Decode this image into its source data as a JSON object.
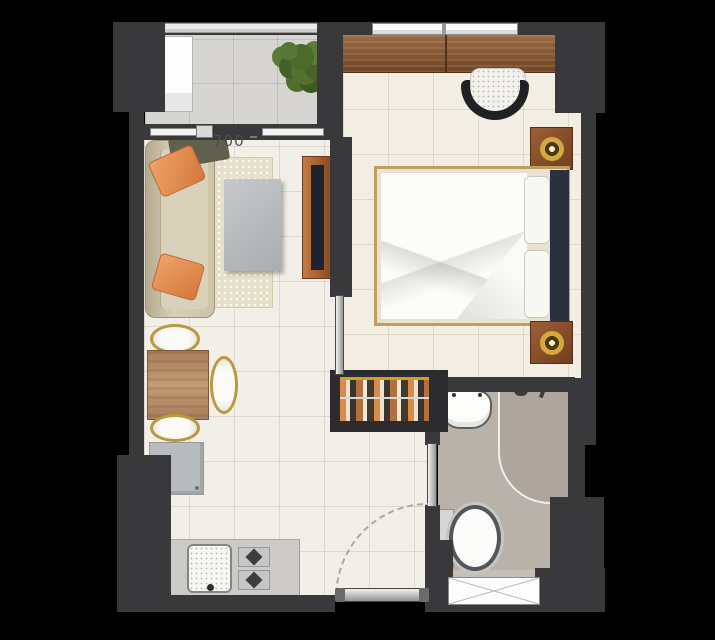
{
  "dimension_label": "700",
  "colors": {
    "background": "#000000",
    "wall": "#39393b",
    "living_floor": "#f1efe8",
    "balcony_floor": "#d7d5d1",
    "bedroom_floor": "#f3eee3",
    "bathroom_floor": "#b9b2aa",
    "wood": "#8a5c3c",
    "sofa_beige": "#cfc5ab",
    "pillow_orange": "#e59057",
    "gold_accent": "#c8a22c",
    "counter_gray": "#cccbc9",
    "headboard_navy": "#2b303f"
  },
  "rooms": {
    "balcony": [
      "potted-plant-icon",
      "ac-unit-icon",
      "balcony-railing",
      "sliding-door-icon"
    ],
    "living_room": [
      "sofa-icon",
      "throw-pillow-icon",
      "blanket-icon",
      "rug-icon",
      "coffee-table-icon",
      "tv-cabinet-icon",
      "tv-icon"
    ],
    "dining_area": [
      "dining-table-icon",
      "dining-chair-icon",
      "sideboard-icon"
    ],
    "kitchen": [
      "kitchen-counter",
      "kitchen-sink-icon",
      "stove-burner-icon"
    ],
    "bedroom": [
      "wardrobe-icon",
      "armchair-icon",
      "bed-icon",
      "duvet-icon",
      "pillow-icon",
      "headboard-icon",
      "nightstand-icon",
      "lamp-icon",
      "bedroom-window",
      "closet-clothes-icon",
      "bedroom-door-icon"
    ],
    "bathroom": [
      "washbasin-icon",
      "shower-icon",
      "toilet-icon",
      "bathroom-window",
      "bathroom-door-icon"
    ],
    "entry": [
      "entrance-door-icon",
      "door-swing-arc"
    ]
  }
}
